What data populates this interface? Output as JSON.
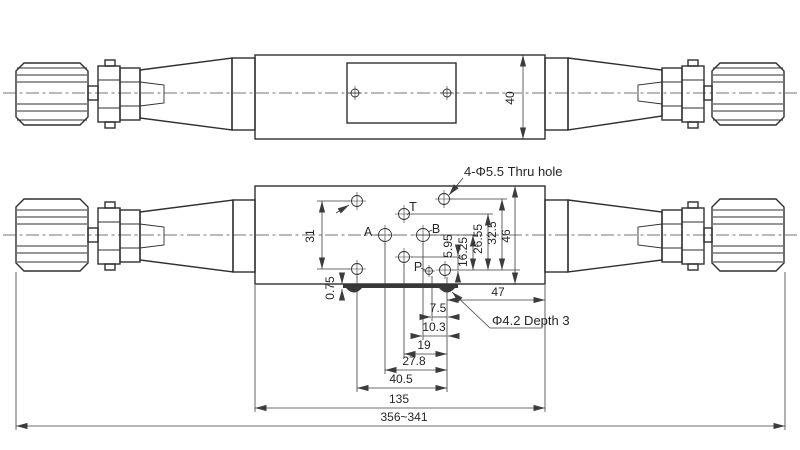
{
  "drawing": {
    "colors": {
      "background": "#ffffff",
      "ink": "#2f2f2f",
      "dim": "#3c3c3c",
      "gasket": "#383838"
    },
    "notes": {
      "thru_hole": "4-Φ5.5  Thru hole",
      "pin_hole": "Φ4.2 Depth 3"
    },
    "ports": {
      "a": "A",
      "b": "B",
      "p": "P",
      "t": "T"
    },
    "dims": {
      "body_height": "40",
      "left_hole_spacing": "31",
      "plate_protrusion": "0.75",
      "p_row_to_mid": "5.95",
      "p_row_to_ab": "16.25",
      "p_row_to_t": "26.55",
      "p_row_to_top": "32.5",
      "body_width": "46",
      "hole_to_right_edge": "47",
      "p_col_offset": "7.5",
      "b_col_offset": "10.3",
      "t_col_offset": "19",
      "a_col_offset": "27.8",
      "bolt_col_span": "40.5",
      "body_length": "135",
      "overall_length": "356~341"
    }
  }
}
